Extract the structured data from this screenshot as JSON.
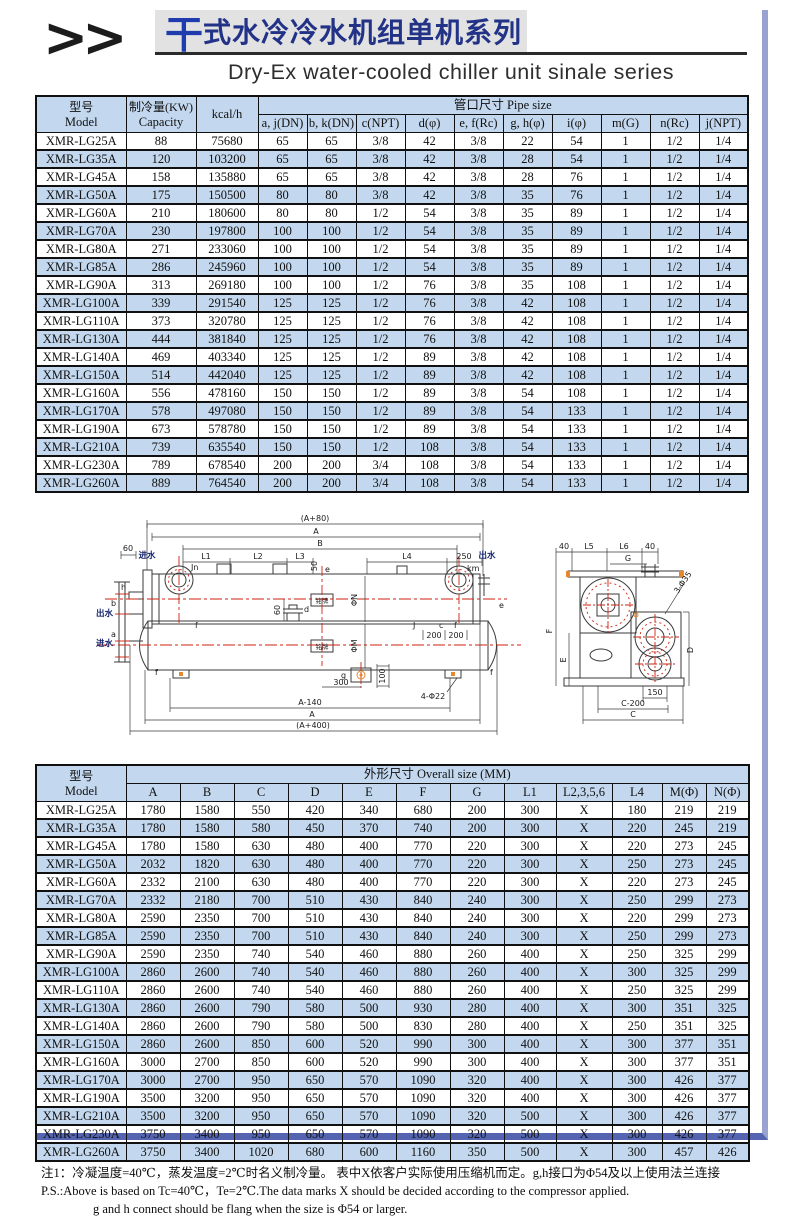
{
  "page": {
    "logo": ">>",
    "title_cn_accent": "干",
    "title_cn_rest": "式水冷冷水机组单机系列",
    "subtitle_en": "Dry-Ex water-cooled chiller unit sinale series"
  },
  "colors": {
    "accent_blue": "#1e3cae",
    "title_navy": "#223287",
    "row_blue": "#c3d8ee",
    "shadow_right": "#9aa2d2",
    "shadow_bottom": "#5464b0",
    "diagram_red": "#cc2211",
    "diagram_orange": "#e8882a"
  },
  "pipe_table": {
    "model_cn": "型号",
    "model_en": "Model",
    "capacity_cn": "制冷量(KW)",
    "capacity_en": "Capacity",
    "kcal": "kcal/h",
    "group": "管口尺寸 Pipe size",
    "subheaders": [
      "a, j(DN)",
      "b, k(DN)",
      "c(NPT)",
      "d(φ)",
      "e, f(Rc)",
      "g, h(φ)",
      "i(φ)",
      "m(G)",
      "n(Rc)",
      "j(NPT)"
    ],
    "rows": [
      [
        "XMR-LG25A",
        "88",
        "75680",
        "65",
        "65",
        "3/8",
        "42",
        "3/8",
        "22",
        "54",
        "1",
        "1/2",
        "1/4"
      ],
      [
        "XMR-LG35A",
        "120",
        "103200",
        "65",
        "65",
        "3/8",
        "42",
        "3/8",
        "28",
        "54",
        "1",
        "1/2",
        "1/4"
      ],
      [
        "XMR-LG45A",
        "158",
        "135880",
        "65",
        "65",
        "3/8",
        "42",
        "3/8",
        "28",
        "76",
        "1",
        "1/2",
        "1/4"
      ],
      [
        "XMR-LG50A",
        "175",
        "150500",
        "80",
        "80",
        "3/8",
        "42",
        "3/8",
        "35",
        "76",
        "1",
        "1/2",
        "1/4"
      ],
      [
        "XMR-LG60A",
        "210",
        "180600",
        "80",
        "80",
        "1/2",
        "54",
        "3/8",
        "35",
        "89",
        "1",
        "1/2",
        "1/4"
      ],
      [
        "XMR-LG70A",
        "230",
        "197800",
        "100",
        "100",
        "1/2",
        "54",
        "3/8",
        "35",
        "89",
        "1",
        "1/2",
        "1/4"
      ],
      [
        "XMR-LG80A",
        "271",
        "233060",
        "100",
        "100",
        "1/2",
        "54",
        "3/8",
        "35",
        "89",
        "1",
        "1/2",
        "1/4"
      ],
      [
        "XMR-LG85A",
        "286",
        "245960",
        "100",
        "100",
        "1/2",
        "54",
        "3/8",
        "35",
        "89",
        "1",
        "1/2",
        "1/4"
      ],
      [
        "XMR-LG90A",
        "313",
        "269180",
        "100",
        "100",
        "1/2",
        "76",
        "3/8",
        "35",
        "108",
        "1",
        "1/2",
        "1/4"
      ],
      [
        "XMR-LG100A",
        "339",
        "291540",
        "125",
        "125",
        "1/2",
        "76",
        "3/8",
        "42",
        "108",
        "1",
        "1/2",
        "1/4"
      ],
      [
        "XMR-LG110A",
        "373",
        "320780",
        "125",
        "125",
        "1/2",
        "76",
        "3/8",
        "42",
        "108",
        "1",
        "1/2",
        "1/4"
      ],
      [
        "XMR-LG130A",
        "444",
        "381840",
        "125",
        "125",
        "1/2",
        "76",
        "3/8",
        "42",
        "108",
        "1",
        "1/2",
        "1/4"
      ],
      [
        "XMR-LG140A",
        "469",
        "403340",
        "125",
        "125",
        "1/2",
        "89",
        "3/8",
        "42",
        "108",
        "1",
        "1/2",
        "1/4"
      ],
      [
        "XMR-LG150A",
        "514",
        "442040",
        "125",
        "125",
        "1/2",
        "89",
        "3/8",
        "42",
        "108",
        "1",
        "1/2",
        "1/4"
      ],
      [
        "XMR-LG160A",
        "556",
        "478160",
        "150",
        "150",
        "1/2",
        "89",
        "3/8",
        "54",
        "108",
        "1",
        "1/2",
        "1/4"
      ],
      [
        "XMR-LG170A",
        "578",
        "497080",
        "150",
        "150",
        "1/2",
        "89",
        "3/8",
        "54",
        "133",
        "1",
        "1/2",
        "1/4"
      ],
      [
        "XMR-LG190A",
        "673",
        "578780",
        "150",
        "150",
        "1/2",
        "89",
        "3/8",
        "54",
        "133",
        "1",
        "1/2",
        "1/4"
      ],
      [
        "XMR-LG210A",
        "739",
        "635540",
        "150",
        "150",
        "1/2",
        "108",
        "3/8",
        "54",
        "133",
        "1",
        "1/2",
        "1/4"
      ],
      [
        "XMR-LG230A",
        "789",
        "678540",
        "200",
        "200",
        "3/4",
        "108",
        "3/8",
        "54",
        "133",
        "1",
        "1/2",
        "1/4"
      ],
      [
        "XMR-LG260A",
        "889",
        "764540",
        "200",
        "200",
        "3/4",
        "108",
        "3/8",
        "54",
        "133",
        "1",
        "1/2",
        "1/4"
      ]
    ]
  },
  "size_table": {
    "model_cn": "型号",
    "model_en": "Model",
    "group": "外形尺寸 Overall size (MM)",
    "subheaders": [
      "A",
      "B",
      "C",
      "D",
      "E",
      "F",
      "G",
      "L1",
      "L2,3,5,6",
      "L4",
      "M(Φ)",
      "N(Φ)"
    ],
    "rows": [
      [
        "XMR-LG25A",
        "1780",
        "1580",
        "550",
        "420",
        "340",
        "680",
        "200",
        "300",
        "X",
        "180",
        "219",
        "219"
      ],
      [
        "XMR-LG35A",
        "1780",
        "1580",
        "580",
        "450",
        "370",
        "740",
        "200",
        "300",
        "X",
        "220",
        "245",
        "219"
      ],
      [
        "XMR-LG45A",
        "1780",
        "1580",
        "630",
        "480",
        "400",
        "770",
        "220",
        "300",
        "X",
        "220",
        "273",
        "245"
      ],
      [
        "XMR-LG50A",
        "2032",
        "1820",
        "630",
        "480",
        "400",
        "770",
        "220",
        "300",
        "X",
        "250",
        "273",
        "245"
      ],
      [
        "XMR-LG60A",
        "2332",
        "2100",
        "630",
        "480",
        "400",
        "770",
        "220",
        "300",
        "X",
        "220",
        "273",
        "245"
      ],
      [
        "XMR-LG70A",
        "2332",
        "2180",
        "700",
        "510",
        "430",
        "840",
        "240",
        "300",
        "X",
        "250",
        "299",
        "273"
      ],
      [
        "XMR-LG80A",
        "2590",
        "2350",
        "700",
        "510",
        "430",
        "840",
        "240",
        "300",
        "X",
        "220",
        "299",
        "273"
      ],
      [
        "XMR-LG85A",
        "2590",
        "2350",
        "700",
        "510",
        "430",
        "840",
        "240",
        "300",
        "X",
        "250",
        "299",
        "273"
      ],
      [
        "XMR-LG90A",
        "2590",
        "2350",
        "740",
        "540",
        "460",
        "880",
        "260",
        "400",
        "X",
        "250",
        "325",
        "299"
      ],
      [
        "XMR-LG100A",
        "2860",
        "2600",
        "740",
        "540",
        "460",
        "880",
        "260",
        "400",
        "X",
        "300",
        "325",
        "299"
      ],
      [
        "XMR-LG110A",
        "2860",
        "2600",
        "740",
        "540",
        "460",
        "880",
        "260",
        "400",
        "X",
        "250",
        "325",
        "299"
      ],
      [
        "XMR-LG130A",
        "2860",
        "2600",
        "790",
        "580",
        "500",
        "930",
        "280",
        "400",
        "X",
        "300",
        "351",
        "325"
      ],
      [
        "XMR-LG140A",
        "2860",
        "2600",
        "790",
        "580",
        "500",
        "830",
        "280",
        "400",
        "X",
        "250",
        "351",
        "325"
      ],
      [
        "XMR-LG150A",
        "2860",
        "2600",
        "850",
        "600",
        "520",
        "990",
        "300",
        "400",
        "X",
        "300",
        "377",
        "351"
      ],
      [
        "XMR-LG160A",
        "3000",
        "2700",
        "850",
        "600",
        "520",
        "990",
        "300",
        "400",
        "X",
        "300",
        "377",
        "351"
      ],
      [
        "XMR-LG170A",
        "3000",
        "2700",
        "950",
        "650",
        "570",
        "1090",
        "320",
        "400",
        "X",
        "300",
        "426",
        "377"
      ],
      [
        "XMR-LG190A",
        "3500",
        "3200",
        "950",
        "650",
        "570",
        "1090",
        "320",
        "400",
        "X",
        "300",
        "426",
        "377"
      ],
      [
        "XMR-LG210A",
        "3500",
        "3200",
        "950",
        "650",
        "570",
        "1090",
        "320",
        "500",
        "X",
        "300",
        "426",
        "377"
      ],
      [
        "XMR-LG230A",
        "3750",
        "3400",
        "950",
        "650",
        "570",
        "1090",
        "320",
        "500",
        "X",
        "300",
        "426",
        "377"
      ],
      [
        "XMR-LG260A",
        "3750",
        "3400",
        "1020",
        "680",
        "600",
        "1160",
        "350",
        "500",
        "X",
        "300",
        "457",
        "426"
      ]
    ]
  },
  "diagram": {
    "side": {
      "dim_a80": "(A+80)",
      "dim_a_top": "A",
      "dim_b": "B",
      "dim_l1": "L1",
      "dim_l2": "L2",
      "dim_l3": "L3",
      "dim_l4": "L4",
      "dim_250": "250",
      "inlet_top": "进水",
      "outlet_top": "出水",
      "jn": "Jn",
      "km": "km",
      "dim_60": "60",
      "dim_60v": "60",
      "dim_50": "50",
      "label_h": "h",
      "label_b": "b",
      "label_a": "a",
      "outlet_left": "出水",
      "inlet_left": "进水",
      "label_f1": "f",
      "label_e": "e",
      "label_d": "d",
      "phi_n": "ΦN",
      "phi_m": "ΦM",
      "label_j": "J",
      "label_c": "c",
      "label_f2": "f",
      "dim_200a": "200",
      "dim_200b": "200",
      "label_g": "g",
      "dim_100": "100",
      "dim_300": "300",
      "dim_a140": "A-140",
      "dim_a_bottom": "A",
      "dim_a400": "(A+400)",
      "dim_4phi22": "4-Φ22",
      "label_e2": "e",
      "label_f3": "f",
      "label_f4": "f",
      "nameplate": "铭牌"
    },
    "end": {
      "dim_40l": "40",
      "dim_l5": "L5",
      "dim_l6": "L6",
      "dim_40r": "40",
      "dim_g": "G",
      "dim_f": "F",
      "dim_e": "E",
      "dim_d": "D",
      "dim_150": "150",
      "dim_c200": "C-200",
      "dim_c": "C",
      "dim_3phi35": "3-Φ35"
    }
  },
  "footnotes": {
    "line1": "注1：冷凝温度=40℃，蒸发温度=2℃时名义制冷量。 表中X依客户实际使用压缩机而定。g,h接口为Φ54及以上使用法兰连接",
    "line2": "P.S.:Above is based on Tc=40℃，Te=2℃.The data marks X should be decided according to the compressor applied.",
    "line3": "g and h connect should be flang when the size is Φ54 or larger."
  }
}
